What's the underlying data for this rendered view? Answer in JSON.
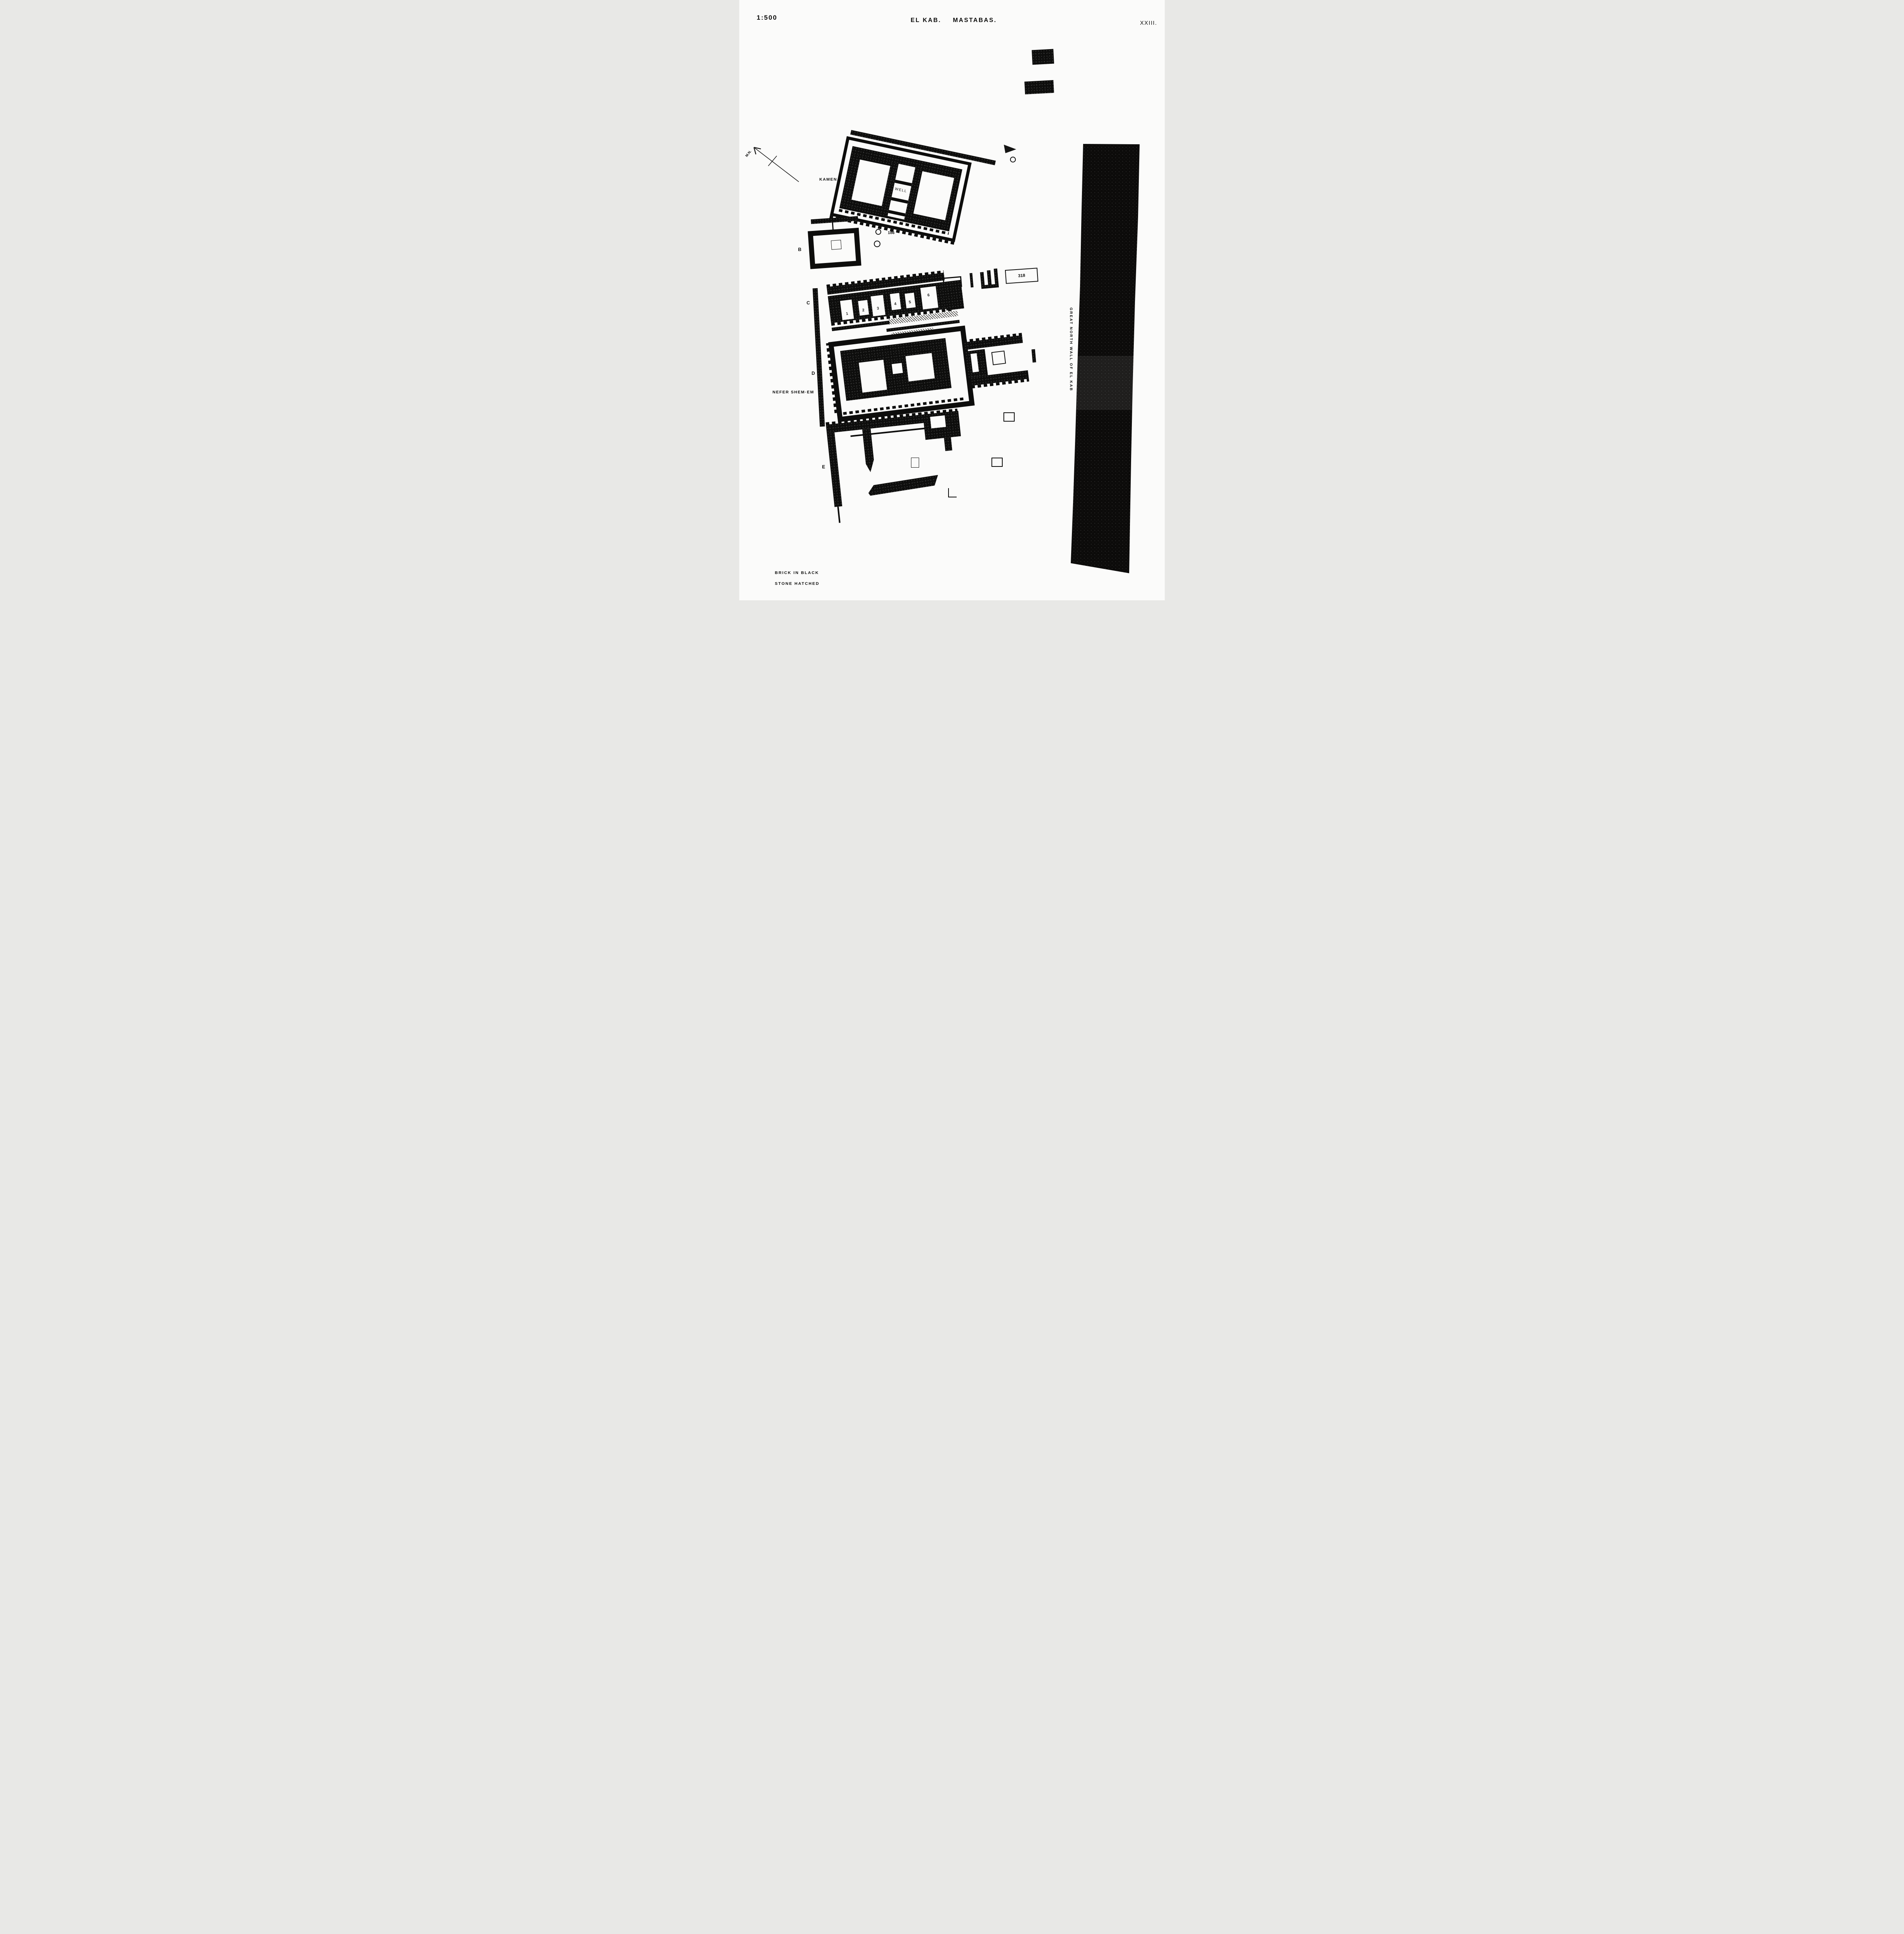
{
  "page": {
    "scale_label": "1:500",
    "title_left": "EL KAB.",
    "title_right": "MASTABAS.",
    "plate_number": "XXIII.",
    "ink_color": "#0d0d0c",
    "paper_color": "#fbfbfa"
  },
  "compass": {
    "label": "M.N."
  },
  "mastaba_a": {
    "label": "A",
    "name": "KAMENA",
    "well_label": "WELL"
  },
  "mastaba_b": {
    "label": "B"
  },
  "tombs": {
    "t186": "186"
  },
  "mastaba_c": {
    "label": "C",
    "chambers": [
      "1",
      "2",
      "3",
      "4",
      "5",
      "6"
    ],
    "tomb_306": "306",
    "tomb_318": "318"
  },
  "mastaba_d": {
    "label": "D",
    "name": "NEFER SHEM·EM"
  },
  "mastaba_e": {
    "label": "E"
  },
  "great_wall": {
    "label": "GREAT NORTH WALL OF EL KAB"
  },
  "legend": {
    "brick": "BRICK IN BLACK",
    "stone": "STONE HATCHED"
  }
}
